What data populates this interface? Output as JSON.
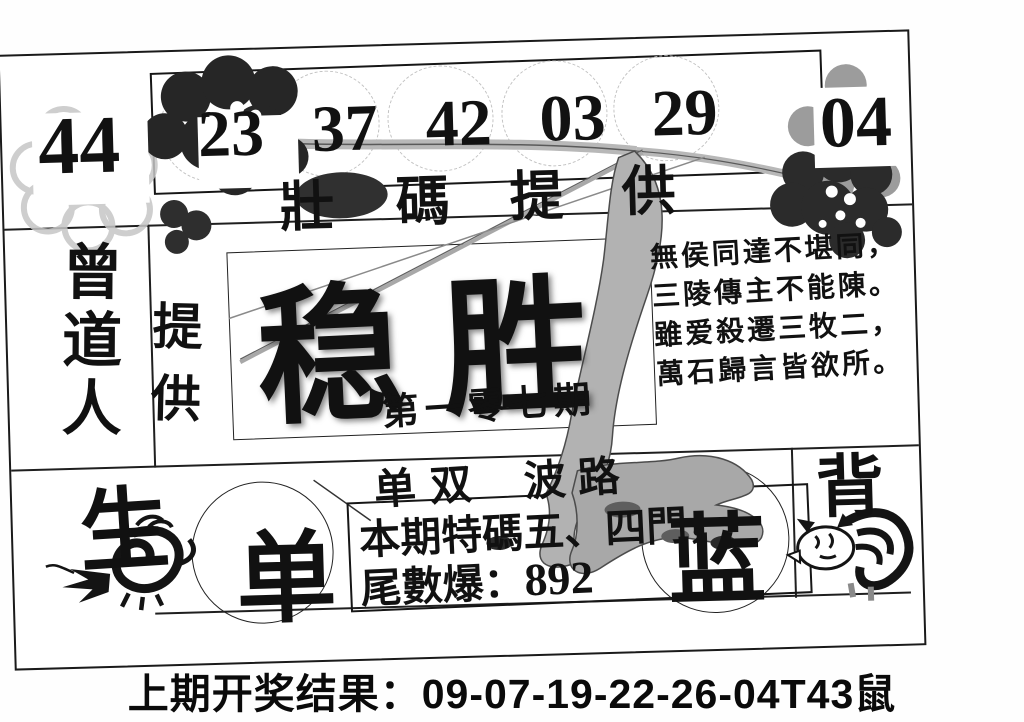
{
  "header_numbers": {
    "left": "44",
    "circled": [
      "23",
      "37",
      "42",
      "03",
      "29"
    ],
    "right": "04"
  },
  "banner": {
    "chars": [
      "壯",
      "碼",
      "提",
      "供"
    ]
  },
  "left_column": {
    "name_vertical": "曾道人",
    "provide": "提供",
    "bottom_char": "生"
  },
  "title": {
    "main": "稳胜",
    "issue": "第一零七期"
  },
  "poem": {
    "lines": [
      "無侯同達不堪同，",
      "三陵傳主不能陳。",
      "雖爱殺遷三牧二，",
      "萬石歸言皆欲所。"
    ]
  },
  "middle": {
    "odd_even": "单双",
    "wave_road": "波路",
    "circle_left": "单",
    "circle_right": "蓝",
    "zodiac_back": "背"
  },
  "tip_box": {
    "line1": "本期特碼五、四門，",
    "line2_label": "尾數爆：",
    "line2_value": "892"
  },
  "footer": {
    "result_line": "上期开奖结果：09-07-19-22-26-04T43鼠"
  },
  "icons": {
    "dragon": "dragon-icon",
    "tiger": "tiger-icon",
    "plum_blossom_left": "plum-blossom-icon",
    "plum_blossom_right": "plum-blossom-icon",
    "branch": "branch-art"
  },
  "colors": {
    "ink": "#111111",
    "branch_gray": "#b0b0b0",
    "paper": "#ffffff"
  }
}
